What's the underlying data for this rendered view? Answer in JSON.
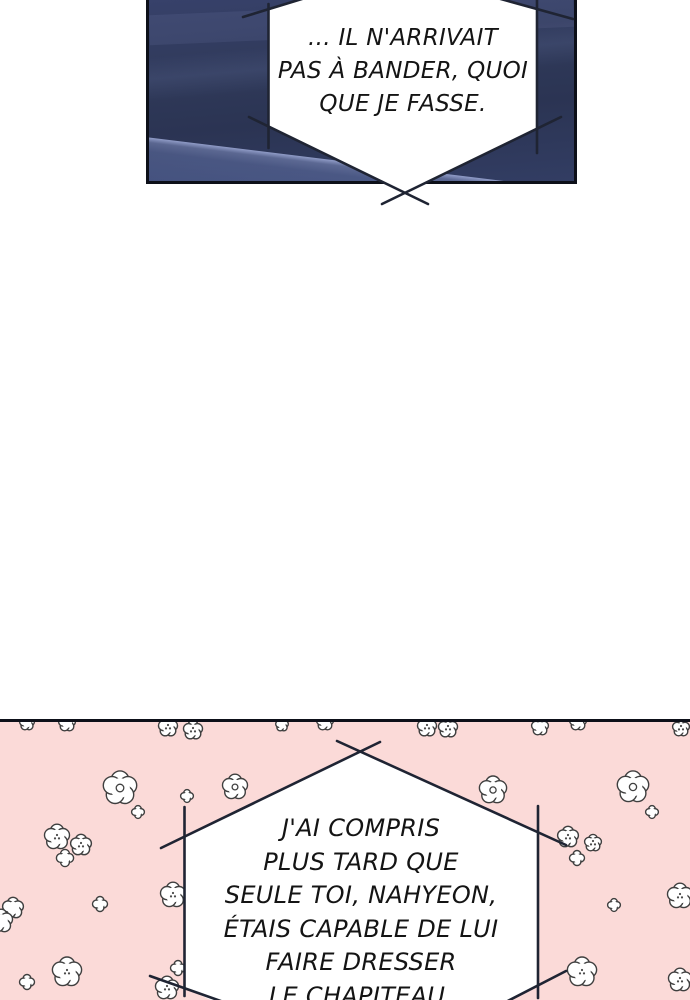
{
  "colors": {
    "page_bg": "#ffffff",
    "navy_base": "#313b5d",
    "pink": "#fbdad8",
    "line": "#1f2433",
    "bubble_fill": "#ffffff",
    "flower_outline": "#3f3f3f",
    "text": "#141414",
    "panel_border": "#0d1019"
  },
  "top_panel": {
    "description": "dark night-room comic panel",
    "bubble_lines": {
      "0": "... IL N'ARRIVAIT",
      "1": "PAS À BANDER, QUOI",
      "2": "QUE JE FASSE."
    }
  },
  "bottom_panel": {
    "description": "pink flower-pattern comic panel",
    "bubble_lines": {
      "0": "J'AI COMPRIS",
      "1": "PLUS TARD QUE",
      "2": "SEULE TOI, NAHYEON,",
      "3": "ÉTAIS CAPABLE DE LUI",
      "4": "FAIRE DRESSER",
      "5": "LE CHAPITEAU."
    },
    "flowers": [
      {
        "x": 27,
        "y": 723,
        "r": 7,
        "t": "plain"
      },
      {
        "x": 67,
        "y": 723,
        "r": 8,
        "t": "plain"
      },
      {
        "x": 168,
        "y": 727,
        "r": 9,
        "t": "dots"
      },
      {
        "x": 193,
        "y": 730,
        "r": 9,
        "t": "dots"
      },
      {
        "x": 282,
        "y": 725,
        "r": 6,
        "t": "plain"
      },
      {
        "x": 325,
        "y": 722,
        "r": 8,
        "t": "plain"
      },
      {
        "x": 427,
        "y": 727,
        "r": 9,
        "t": "dots"
      },
      {
        "x": 448,
        "y": 728,
        "r": 9,
        "t": "dots"
      },
      {
        "x": 540,
        "y": 727,
        "r": 8,
        "t": "plain"
      },
      {
        "x": 578,
        "y": 722,
        "r": 8,
        "t": "plain"
      },
      {
        "x": 681,
        "y": 728,
        "r": 8,
        "t": "dots"
      },
      {
        "x": 120,
        "y": 788,
        "r": 16,
        "t": "ring"
      },
      {
        "x": 235,
        "y": 787,
        "r": 12,
        "t": "ring"
      },
      {
        "x": 138,
        "y": 812,
        "r": 6,
        "t": "mini"
      },
      {
        "x": 187,
        "y": 796,
        "r": 6,
        "t": "mini"
      },
      {
        "x": 57,
        "y": 837,
        "r": 12,
        "t": "dots"
      },
      {
        "x": 81,
        "y": 845,
        "r": 10,
        "t": "dots"
      },
      {
        "x": 65,
        "y": 858,
        "r": 8,
        "t": "mini"
      },
      {
        "x": 13,
        "y": 908,
        "r": 10,
        "t": "plain"
      },
      {
        "x": 1,
        "y": 921,
        "r": 11,
        "t": "plain"
      },
      {
        "x": 100,
        "y": 904,
        "r": 7,
        "t": "mini"
      },
      {
        "x": 173,
        "y": 895,
        "r": 12,
        "t": "dots"
      },
      {
        "x": 67,
        "y": 972,
        "r": 14,
        "t": "dots"
      },
      {
        "x": 27,
        "y": 982,
        "r": 7,
        "t": "mini"
      },
      {
        "x": 178,
        "y": 968,
        "r": 7,
        "t": "mini"
      },
      {
        "x": 167,
        "y": 988,
        "r": 11,
        "t": "dots"
      },
      {
        "x": 493,
        "y": 790,
        "r": 13,
        "t": "ring"
      },
      {
        "x": 633,
        "y": 787,
        "r": 15,
        "t": "ring"
      },
      {
        "x": 652,
        "y": 812,
        "r": 6,
        "t": "mini"
      },
      {
        "x": 568,
        "y": 837,
        "r": 10,
        "t": "dots"
      },
      {
        "x": 593,
        "y": 843,
        "r": 8,
        "t": "dots"
      },
      {
        "x": 577,
        "y": 858,
        "r": 7,
        "t": "mini"
      },
      {
        "x": 614,
        "y": 905,
        "r": 6,
        "t": "mini"
      },
      {
        "x": 680,
        "y": 896,
        "r": 12,
        "t": "dots"
      },
      {
        "x": 582,
        "y": 972,
        "r": 14,
        "t": "dots"
      },
      {
        "x": 680,
        "y": 980,
        "r": 11,
        "t": "dots"
      }
    ]
  }
}
